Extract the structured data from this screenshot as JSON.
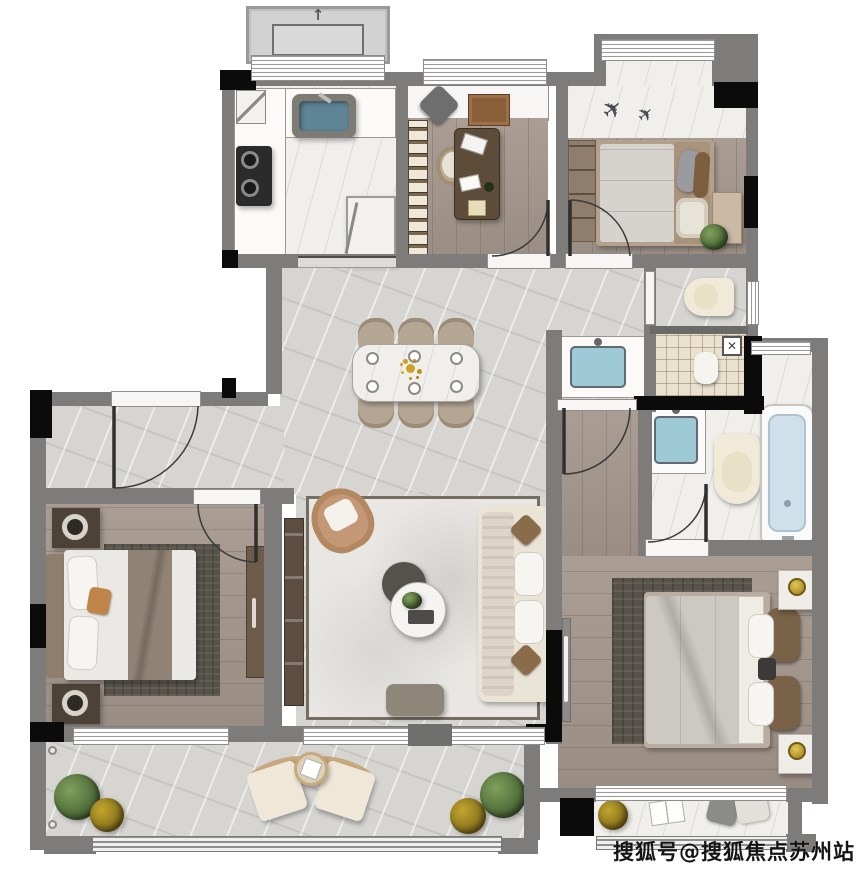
{
  "watermark": {
    "text": "搜狐号@搜狐焦点苏州站"
  },
  "palette": {
    "wall": "#7d7c7a",
    "column": "#0b0b0b",
    "marble_gray": "#d6d5d2",
    "marble_white": "#f1efec",
    "wood": "#a3968c",
    "wood_dark": "#5c4d40",
    "tile": "#eae1cf",
    "sink_blue": "#9ec9d6",
    "tub_blue": "#cfe0ea",
    "cream": "#f2ead8",
    "sofa": "#eae4d6",
    "rug_dark": "#57534b",
    "rug_light": "#e9e7e3",
    "tan": "#c49877",
    "gold": "#c9a425",
    "plant_green": "#4e6b38",
    "plant_yellow": "#9c7f1e"
  },
  "decor": {
    "ac_arrow": "↑",
    "airplane": "✈",
    "washer_mark": "✕"
  }
}
